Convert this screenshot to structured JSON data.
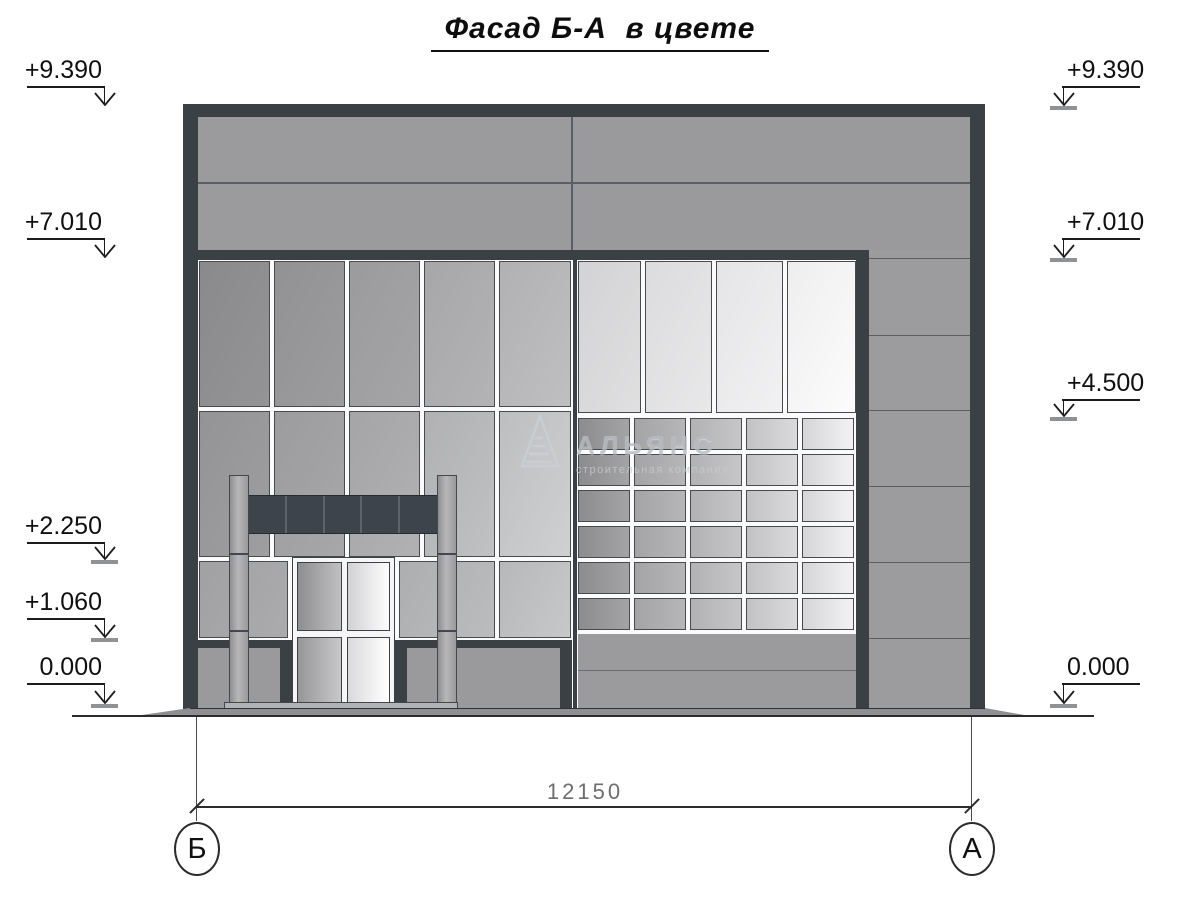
{
  "title": {
    "text": "Фасад Б-А  в цвете"
  },
  "watermark": {
    "name": "АЛЬЯНС",
    "subtitle": "строительная компания"
  },
  "dimension": {
    "value": "12150"
  },
  "axes": [
    {
      "label": "Б",
      "x": 197
    },
    {
      "label": "А",
      "x": 972
    }
  ],
  "markers": {
    "left": [
      {
        "label": "+9.390",
        "line_y": 86,
        "tip_y": 105,
        "tick": false
      },
      {
        "label": "+7.010",
        "line_y": 238,
        "tip_y": 257,
        "tick": false
      },
      {
        "label": "+2.250",
        "line_y": 542,
        "tip_y": 559,
        "tick": true
      },
      {
        "label": "+1.060",
        "line_y": 618,
        "tip_y": 637,
        "tick": true
      },
      {
        "label": "0.000",
        "line_y": 683,
        "tip_y": 703,
        "tick": true
      }
    ],
    "right": [
      {
        "label": "+9.390",
        "line_y": 86,
        "tip_y": 105,
        "tick": true
      },
      {
        "label": "+7.010",
        "line_y": 238,
        "tip_y": 257,
        "tick": true
      },
      {
        "label": "+4.500",
        "line_y": 399,
        "tip_y": 416,
        "tick": true
      },
      {
        "label": "0.000",
        "line_y": 683,
        "tip_y": 703,
        "tick": true
      }
    ],
    "layout": {
      "left": {
        "x1": 27,
        "x2": 105,
        "drop_x": 104,
        "text_x": 18,
        "text_w": 84,
        "align": "right"
      },
      "right": {
        "x1": 1062,
        "x2": 1140,
        "drop_x": 1063,
        "text_x": 1067,
        "text_w": 90,
        "align": "left"
      }
    }
  },
  "palette": {
    "dark_frame": "#3b4045",
    "joint_dark": "#5b5f63",
    "panel_gray": "#9b9b9d",
    "sign_dark": "#3d444b",
    "plinth_gray": "#9a9a9c",
    "slab_gray": "#8d8f92",
    "dim_text": "#6e6e6e",
    "watermark_gray": "#b8bcc0"
  },
  "facade": {
    "grids": [
      {
        "name": "parapet",
        "dir": 115,
        "bordered": false,
        "rows": [
          [
            117,
            65
          ],
          [
            184,
            66
          ]
        ],
        "cols": [
          [
            198,
            373,
            "#9b9b9d"
          ],
          [
            573,
            397,
            "#9a9a9c"
          ]
        ]
      },
      {
        "name": "right-column",
        "dir": 115,
        "bordered": false,
        "rows": [
          [
            250,
            8
          ],
          [
            259,
            76
          ],
          [
            336,
            74
          ],
          [
            411,
            75
          ],
          [
            487,
            75
          ],
          [
            563,
            75
          ],
          [
            639,
            71
          ]
        ],
        "cols": [
          [
            869,
            101,
            "#9c9c9f"
          ]
        ]
      },
      {
        "name": "left-row1",
        "dir": 115,
        "bordered": true,
        "rows": [
          [
            261,
            146
          ]
        ],
        "cols": [
          [
            199,
            71,
            "#8a8a8c",
            "#949496"
          ],
          [
            274,
            71,
            "#929294",
            "#9c9c9e"
          ],
          [
            349,
            71,
            "#9b9b9d",
            "#a5a5a7"
          ],
          [
            424,
            71,
            "#a7a7a9",
            "#b3b3b5"
          ],
          [
            499,
            72,
            "#b1b1b3",
            "#bfbfc1"
          ]
        ]
      },
      {
        "name": "left-row2",
        "dir": 115,
        "bordered": true,
        "rows": [
          [
            411,
            146
          ]
        ],
        "cols": [
          [
            199,
            71,
            "#949496",
            "#9e9ea0"
          ],
          [
            274,
            71,
            "#9c9c9e",
            "#a7a7a9"
          ],
          [
            349,
            71,
            "#a5a5a7",
            "#b1b1b3"
          ],
          [
            424,
            71,
            "#b1b1b3",
            "#bfc1c3"
          ],
          [
            499,
            72,
            "#bcbec0",
            "#ced0d2"
          ]
        ]
      },
      {
        "name": "left-row3",
        "dir": 115,
        "bordered": true,
        "rows": [
          [
            561,
            77
          ]
        ],
        "cols": [
          [
            199,
            89,
            "#a1a1a3",
            "#ababad"
          ],
          [
            399,
            96,
            "#acaeb0",
            "#babcbe"
          ],
          [
            499,
            72,
            "#b6b8ba",
            "#c6c8ca"
          ]
        ]
      },
      {
        "name": "right-tall",
        "dir": 115,
        "bordered": true,
        "rows": [
          [
            261,
            152
          ]
        ],
        "cols": [
          [
            578,
            63,
            "#d3d3d5",
            "#dfdfe0"
          ],
          [
            645,
            67,
            "#dcdcde",
            "#e8e8e9"
          ],
          [
            716,
            67,
            "#e5e5e7",
            "#f1f1f2"
          ],
          [
            787,
            69,
            "#eeeeef",
            "#fcfcfd"
          ]
        ]
      },
      {
        "name": "window-grid",
        "dir": 90,
        "bordered": true,
        "rows": [
          [
            418,
            32
          ],
          [
            454,
            32
          ],
          [
            490,
            32
          ],
          [
            526,
            32
          ],
          [
            562,
            32
          ],
          [
            598,
            32
          ]
        ],
        "cols": [
          [
            578,
            52,
            "#8c8c8e",
            "#a4a4a6"
          ],
          [
            634,
            52,
            "#a4a4a6",
            "#b6b6b8"
          ],
          [
            690,
            52,
            "#b2b2b4",
            "#c6c6c8"
          ],
          [
            746,
            52,
            "#c2c2c4",
            "#dadadc"
          ],
          [
            802,
            52,
            "#d6d6d8",
            "#f2f2f4"
          ]
        ]
      },
      {
        "name": "lower-right-wall",
        "dir": 115,
        "bordered": false,
        "rows": [
          [
            634,
            36
          ],
          [
            671,
            39
          ]
        ],
        "cols": [
          [
            578,
            278,
            "#9b9b9d"
          ]
        ]
      }
    ]
  }
}
